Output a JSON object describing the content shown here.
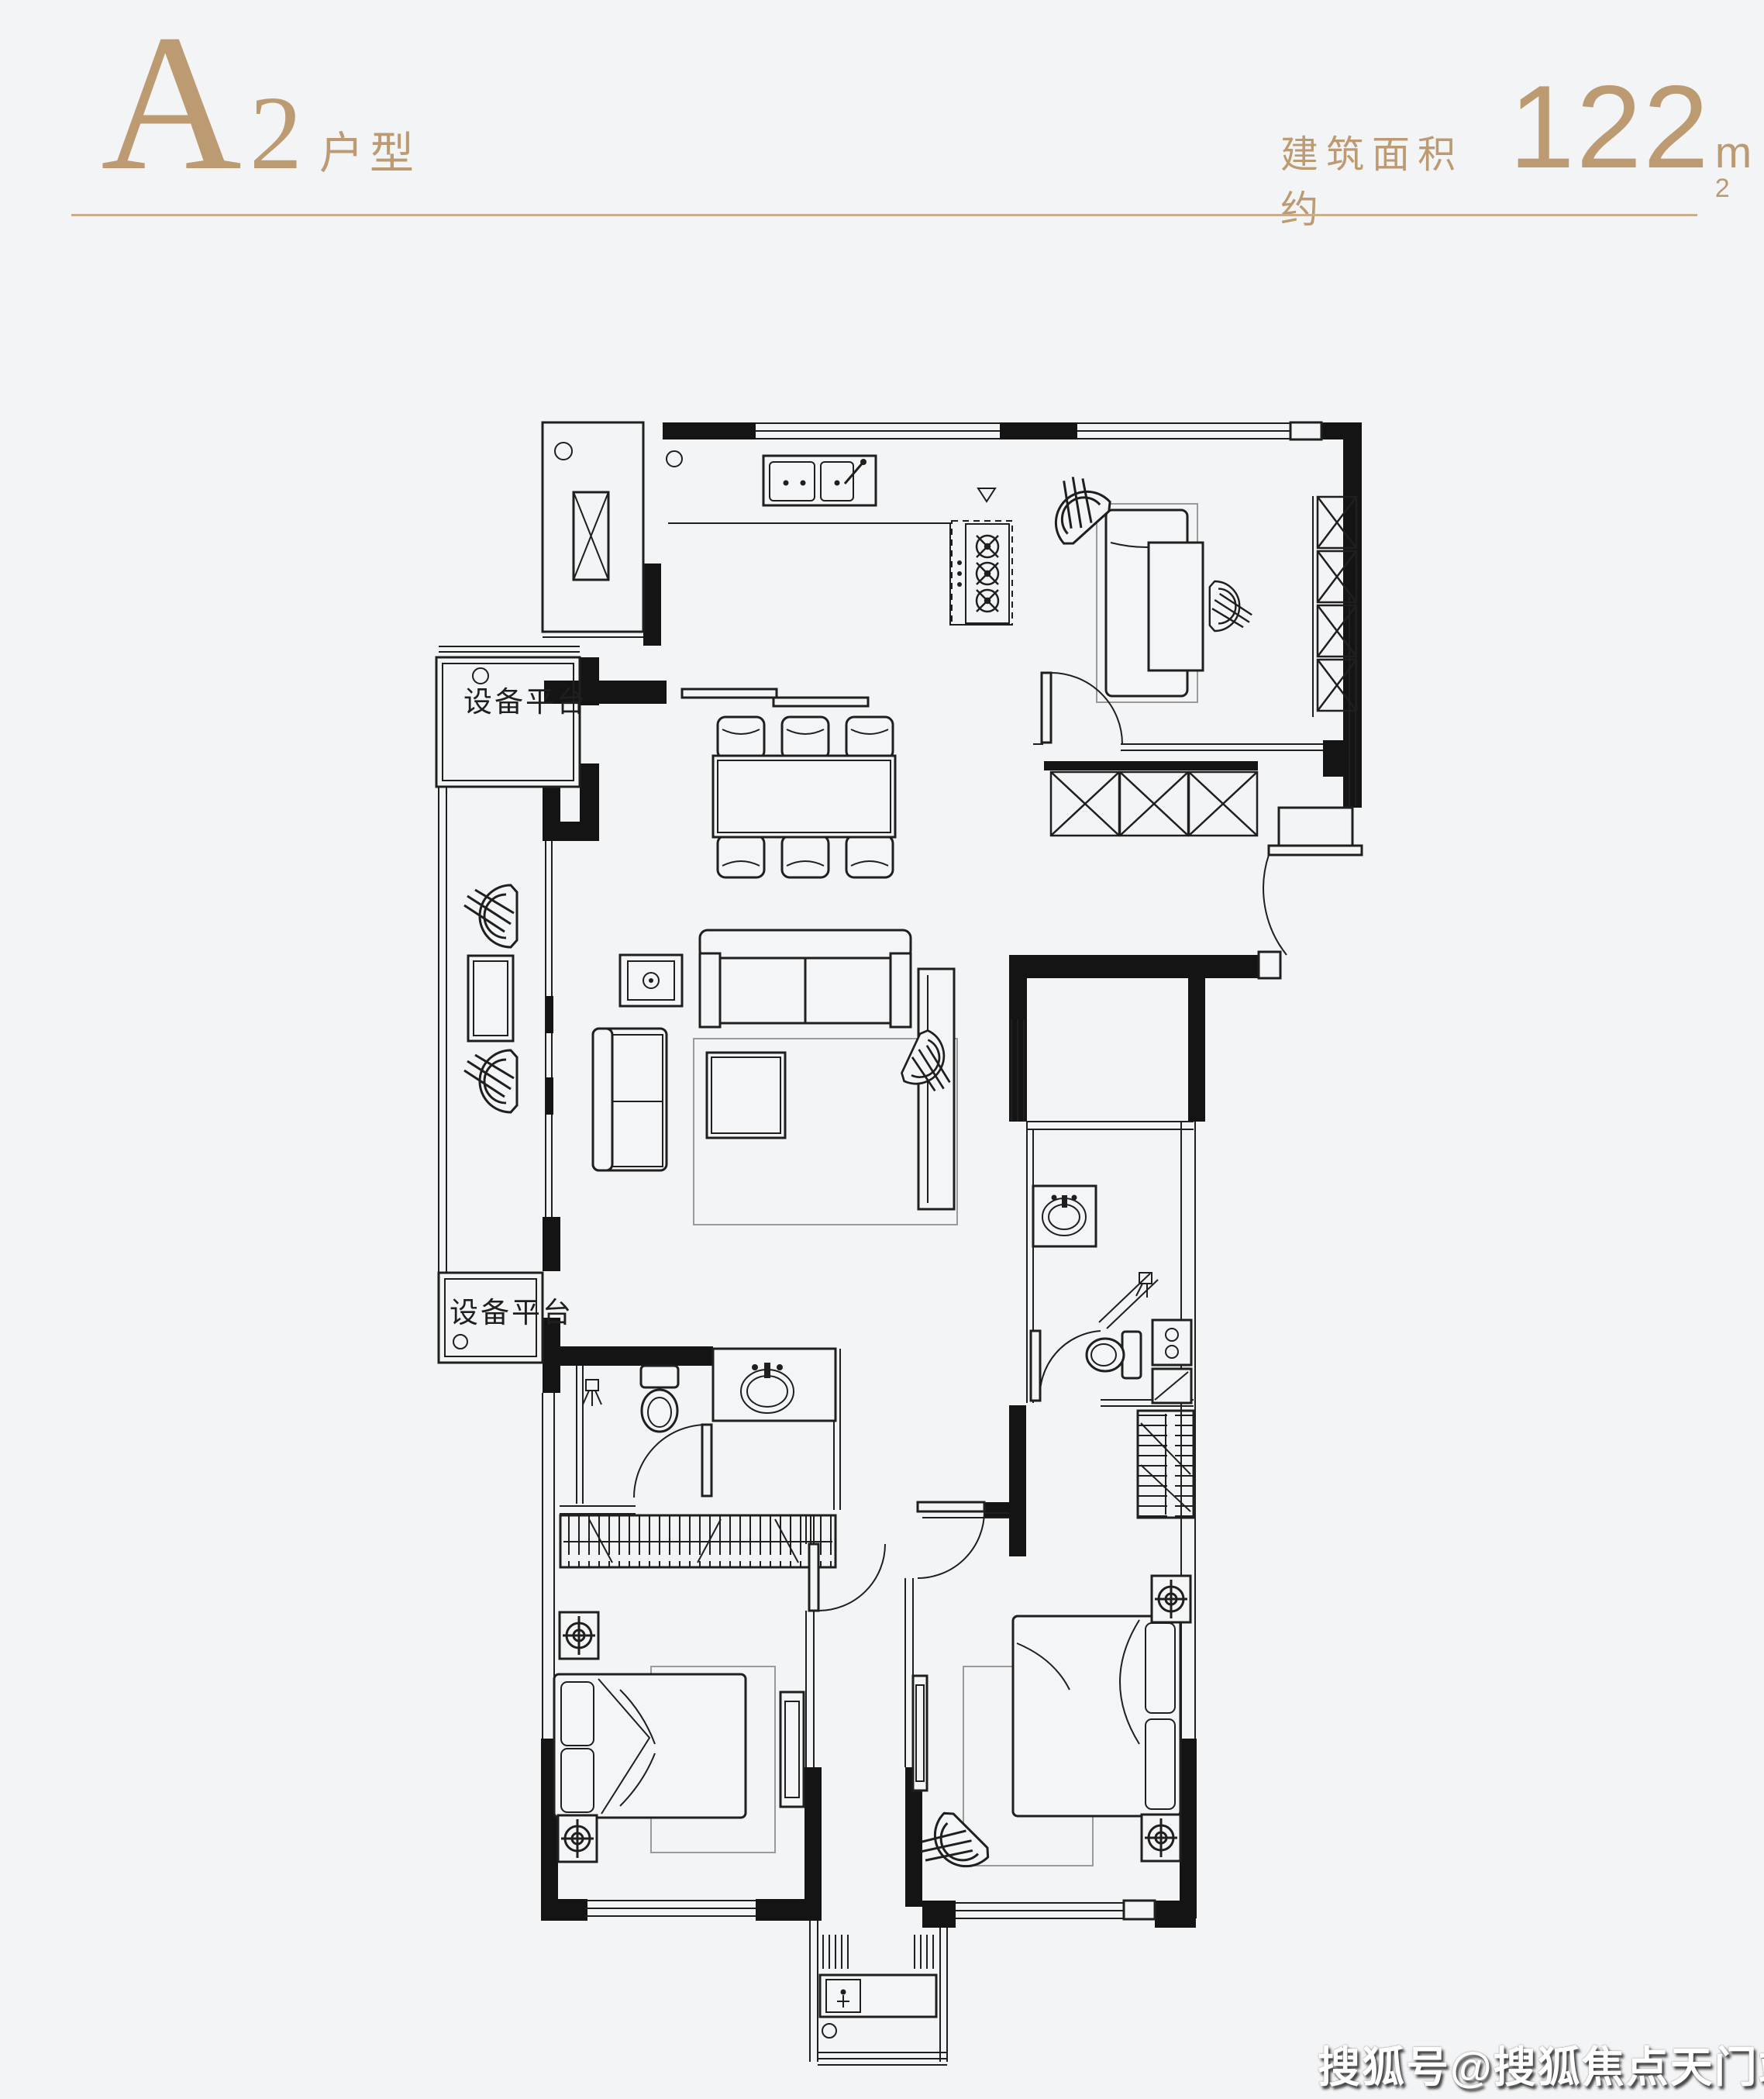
{
  "header": {
    "unit_letter": "A",
    "unit_number": "2",
    "unit_suffix": "户型",
    "area_label": "建筑面积约",
    "area_value": "122",
    "area_unit_base": "m",
    "area_unit_exp": "2",
    "accent_color": "#bd9b72",
    "divider_color": "#cbad8b"
  },
  "plan": {
    "platform_label_top": "设备平台",
    "platform_label_bottom": "设备平台",
    "line_color": "#1f1f1f",
    "wall_color": "#141414",
    "background_color": "#f3f4f6"
  },
  "watermark": {
    "text": "搜狐号@搜狐焦点天门站"
  }
}
